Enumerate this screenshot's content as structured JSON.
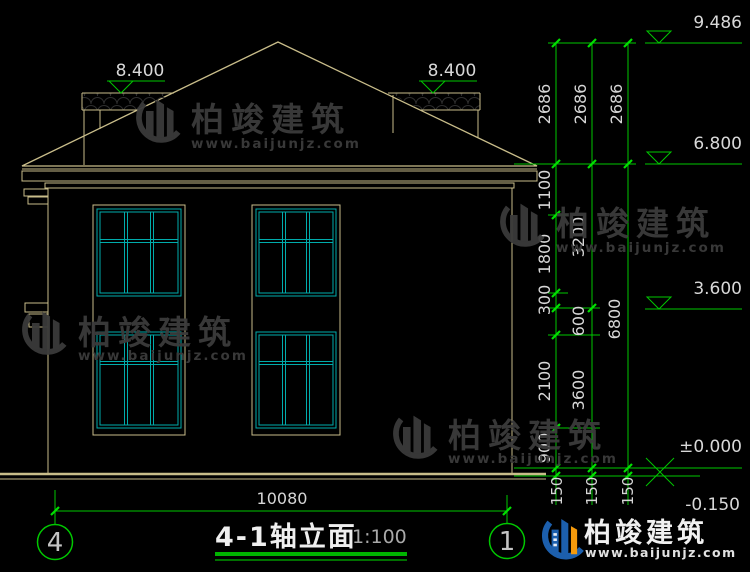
{
  "drawing": {
    "title": "4-1轴立面",
    "scale": "1:100",
    "axis_start": "4",
    "axis_end": "1",
    "total_width_dim": "10080"
  },
  "elevation_markers": {
    "ridge": "9.486",
    "side_roof_left": "8.400",
    "side_roof_right": "8.400",
    "eave": "6.800",
    "second_floor": "3.600",
    "ground_floor": "±0.000",
    "site": "-0.150"
  },
  "right_dimensions": {
    "col1": [
      "2686",
      "1100",
      "1800",
      "300",
      "600",
      "2100",
      "900",
      "150"
    ],
    "col2": [
      "2686",
      "3200",
      "3600",
      "150"
    ],
    "col3": [
      "2686",
      "6800",
      "150"
    ]
  },
  "watermark": {
    "brand": "柏竣建筑",
    "url": "www.baijunjz.com"
  },
  "footer_logo": {
    "brand": "柏竣建筑",
    "url": "www.baijunjz.com"
  }
}
